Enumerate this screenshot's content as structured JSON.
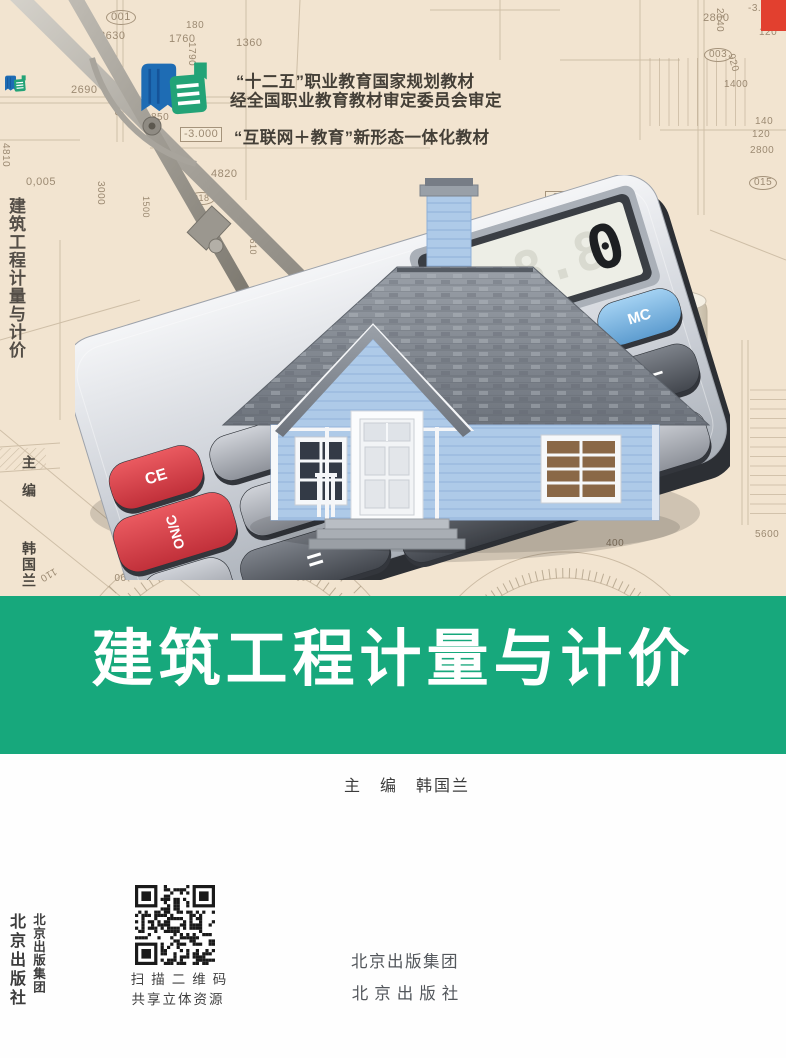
{
  "meta": {
    "bg_color": "#f2e4d0",
    "band_green": "#17a87c",
    "corner_red": "#e2402f",
    "logo_blue": "#1e6cb4",
    "logo_green": "#23a377"
  },
  "badges": {
    "line1": "“十二五”职业教育国家规划教材",
    "line2": "经全国职业教育教材审定委员会审定",
    "line3": "“互联网＋教育”新形态一体化教材"
  },
  "title_band": {
    "title": "建筑工程计量与计价",
    "editor_line": "主　编　韩国兰"
  },
  "spine": {
    "title": "建筑工程计量与计价",
    "editor_role": "主编",
    "editor_name": "韩国兰",
    "publisher_press": "北京出版社",
    "publisher_group": "北京出版集团"
  },
  "qr": {
    "caption1": "扫描二维码",
    "caption2": "共享立体资源"
  },
  "publisher": {
    "group": "北京出版集团",
    "press": "北京出版社"
  },
  "calculator": {
    "display": "0",
    "display_ghost": "8.8.8",
    "keys": {
      "ce": "CE",
      "on": "ON/C",
      "mc": "MC",
      "divide": "÷",
      "multiply": "×",
      "minus": "−",
      "plus": "+",
      "equals": "=",
      "zero": "0",
      "dot": "·"
    }
  },
  "blueprint": {
    "labels": [
      "001",
      "2630",
      "180",
      "1760",
      "1360",
      "1790",
      "2690",
      "2670",
      "850",
      "-3.000",
      "5",
      "4820",
      "0,005",
      "3000",
      "4810",
      "2800",
      "2140",
      "-3.000",
      "140",
      "120",
      "003",
      "920",
      "1400",
      "140",
      "120",
      "2800",
      "015",
      "-3.000",
      "018",
      "1500",
      "5610",
      "5610",
      "400",
      "5600",
      "100",
      "110",
      "120",
      "130",
      "90",
      "110",
      "30",
      "20"
    ]
  }
}
